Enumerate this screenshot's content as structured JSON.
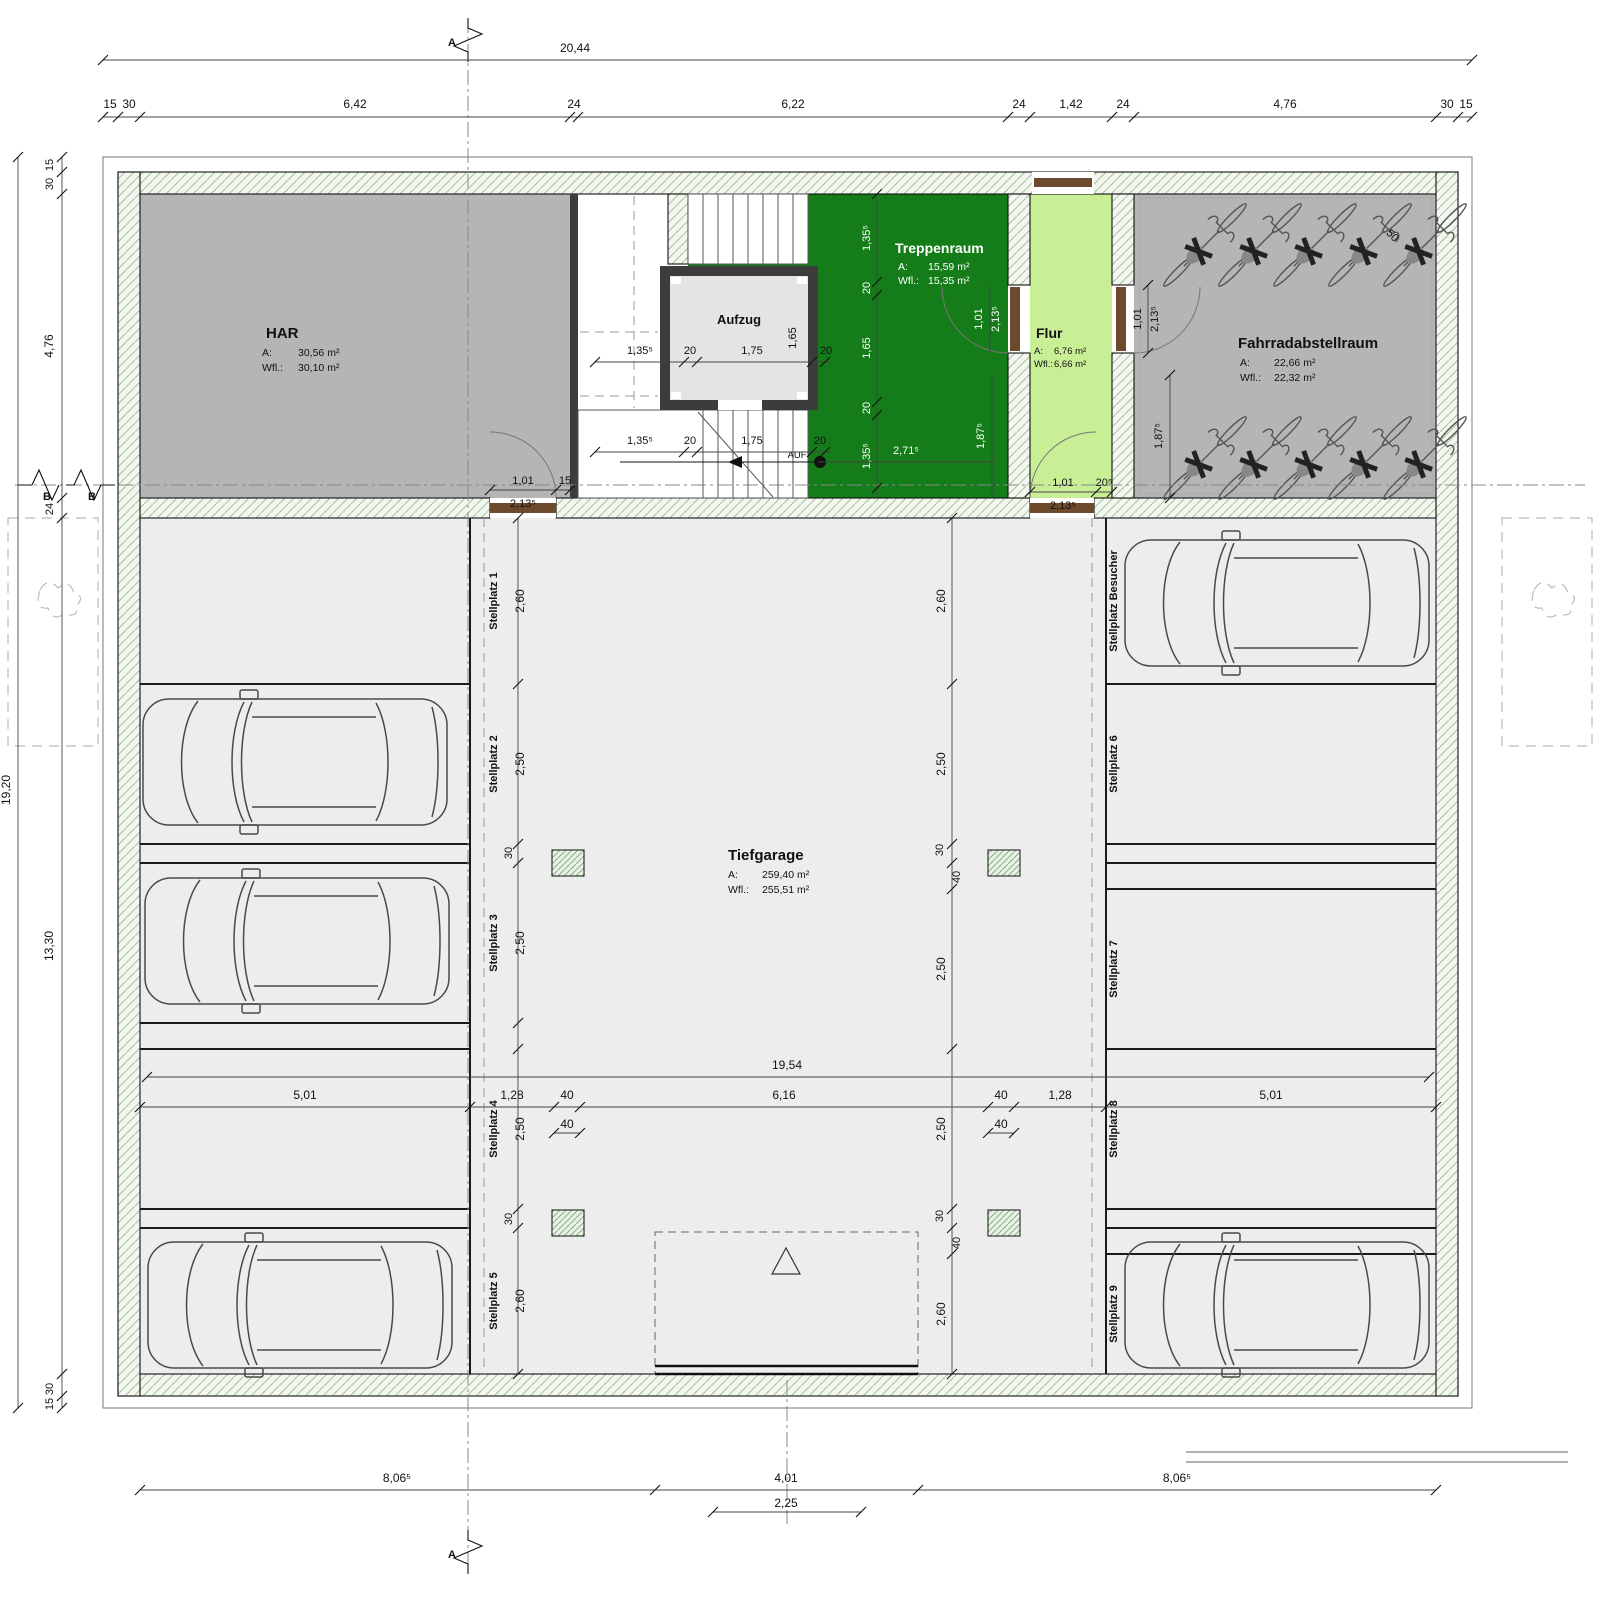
{
  "rooms": {
    "har": {
      "name": "HAR",
      "a_label": "A:",
      "a_value": "30,56 m²",
      "w_label": "Wfl.:",
      "w_value": "30,10 m²"
    },
    "aufzug": {
      "name": "Aufzug"
    },
    "treppenraum": {
      "name": "Treppenraum",
      "a_label": "A:",
      "a_value": "15,59 m²",
      "w_label": "Wfl.:",
      "w_value": "15,35 m²"
    },
    "flur": {
      "name": "Flur",
      "a_label": "A:",
      "a_value": "6,76 m²",
      "w_label": "Wfl.:",
      "w_value": "6,66 m²"
    },
    "fahrradraum": {
      "name": "Fahrradabstellraum",
      "a_label": "A:",
      "a_value": "22,66 m²",
      "w_label": "Wfl.:",
      "w_value": "22,32 m²"
    },
    "tiefgarage": {
      "name": "Tiefgarage",
      "a_label": "A:",
      "a_value": "259,40 m²",
      "w_label": "Wfl.:",
      "w_value": "255,51 m²"
    }
  },
  "stalls": {
    "s1": "Stellplatz 1",
    "s2": "Stellplatz 2",
    "s3": "Stellplatz 3",
    "s4": "Stellplatz 4",
    "s5": "Stellplatz 5",
    "s6": "Stellplatz 6",
    "s7": "Stellplatz 7",
    "s8": "Stellplatz 8",
    "s9": "Stellplatz 9",
    "besucher": "Stellplatz Besucher"
  },
  "dims": {
    "overall_width": "20,44",
    "overall_height": "19,20",
    "top": [
      "15",
      "30",
      "6,42",
      "24",
      "6,22",
      "24",
      "1,42",
      "24",
      "4,76",
      "30",
      "15"
    ],
    "left": [
      "15",
      "30",
      "4,76",
      "24",
      "13,30",
      "30",
      "15"
    ],
    "bottom": [
      "8,06⁵",
      "4,01",
      "8,06⁵"
    ],
    "bottom_sub": "2,25",
    "aisle_length": "19,54",
    "mid": [
      "5,01",
      "1,28",
      "40",
      "6,16",
      "40",
      "1,28",
      "5,01"
    ],
    "mid_sub": [
      "40",
      "40"
    ],
    "stalls_left": [
      "2,60",
      "2,50",
      "30",
      "2,50",
      "2,50",
      "30",
      "2,60"
    ],
    "stalls_right": [
      "2,60",
      "2,50",
      "30",
      "40",
      "2,50",
      "2,50",
      "30",
      "40",
      "2,60"
    ],
    "stair_mid": [
      "1,35⁵",
      "20",
      "1,75",
      "1,65",
      "20"
    ],
    "stair_low": [
      "1,35⁵",
      "20",
      "1,75",
      "20"
    ],
    "stair_vert": [
      "1,35⁵",
      "20",
      "1,65",
      "20",
      "1,35⁵"
    ],
    "treppenraum_w": "2,71⁵",
    "treppenraum_h": "1,87⁵",
    "door_har": [
      "1,01",
      "2,13⁵",
      "15"
    ],
    "door_trepp": [
      "1,01",
      "2,13⁵"
    ],
    "door_rad": [
      "1,01",
      "2,13⁵",
      "1,87⁵"
    ],
    "door_flur": [
      "1,01",
      "2,13⁵",
      "20⁵"
    ],
    "bike_rack": "50"
  },
  "annotations": {
    "stair_direction": "AUF"
  },
  "markers": {
    "section_a": "A",
    "section_b": "B"
  },
  "colors": {
    "treppenraum": "#147d19",
    "flur": "#c9ef96",
    "room_gray": "#b5b5b5",
    "garage_floor": "#ededed",
    "elevator_cab": "#e4e4e4",
    "elevator_wall": "#3c3c3c",
    "door_leaf": "#6d4a2b",
    "wall_dark": "#3c3c3c"
  }
}
